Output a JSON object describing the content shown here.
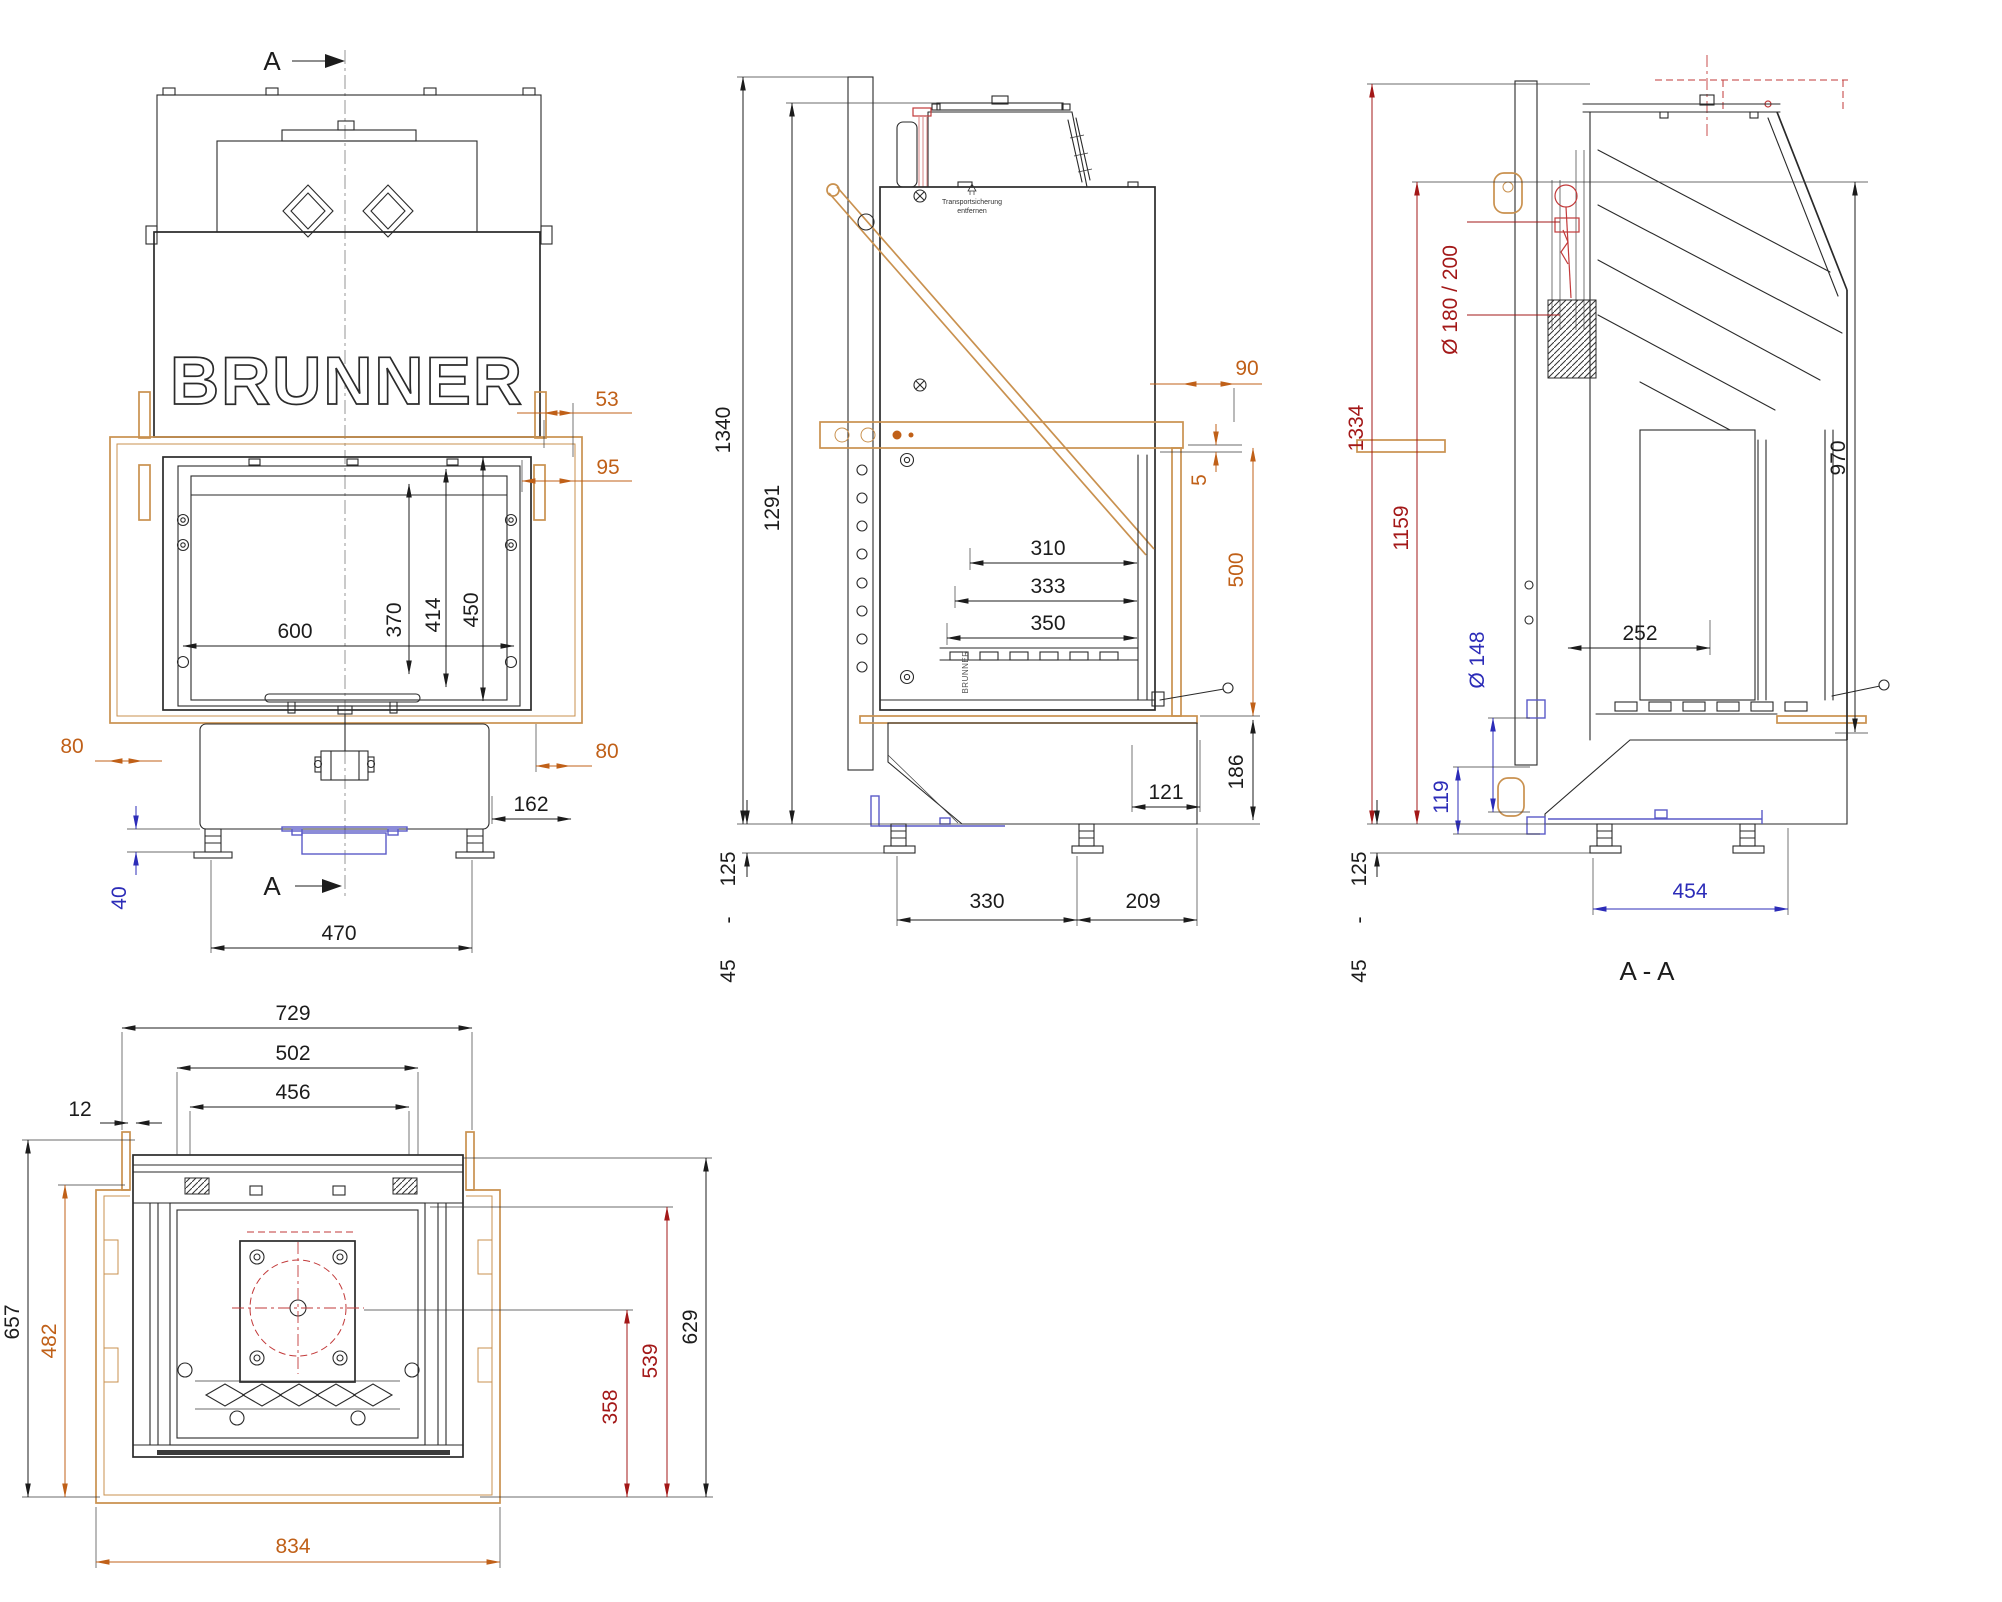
{
  "brand": "BRUNNER",
  "labels": {
    "section_marker": "A",
    "section_view": "A  -  A",
    "transport1": "Transportsicherung",
    "transport2": "entfernen"
  },
  "dims": {
    "front": {
      "d53": "53",
      "d95": "95",
      "d370": "370",
      "d414": "414",
      "d450": "450",
      "d600": "600",
      "d80_left": "80",
      "d80_right": "80",
      "d162": "162",
      "d40": "40",
      "d470": "470"
    },
    "side": {
      "d1340": "1340",
      "d1291": "1291",
      "d90": "90",
      "d5": "5",
      "d500": "500",
      "d310": "310",
      "d333": "333",
      "d350": "350",
      "d121": "121",
      "d186": "186",
      "range_high": "125",
      "range_dash": "-",
      "range_low": "45",
      "d330": "330",
      "d209": "209"
    },
    "section": {
      "d1334": "1334",
      "d1159": "1159",
      "flue_diameter": "Ø  180  /  200",
      "d970": "970",
      "d252": "252",
      "air_diameter": "Ø  148",
      "d119": "119",
      "range_high": "125",
      "range_dash": "-",
      "range_low": "45",
      "d454": "454"
    },
    "plan": {
      "d729": "729",
      "d502": "502",
      "d456": "456",
      "d12": "12",
      "d657": "657",
      "d482": "482",
      "d629": "629",
      "d539": "539",
      "d358": "358",
      "d834": "834"
    }
  },
  "colors": {
    "dimension_black": "#1c1c1c",
    "dimension_orange": "#c06018",
    "dimension_dark_red": "#a31818",
    "dimension_blue": "#2c2cb8",
    "frame_tan": "#c9914f",
    "part_red": "#c23a3a",
    "part_blue": "#5a5ac8"
  }
}
